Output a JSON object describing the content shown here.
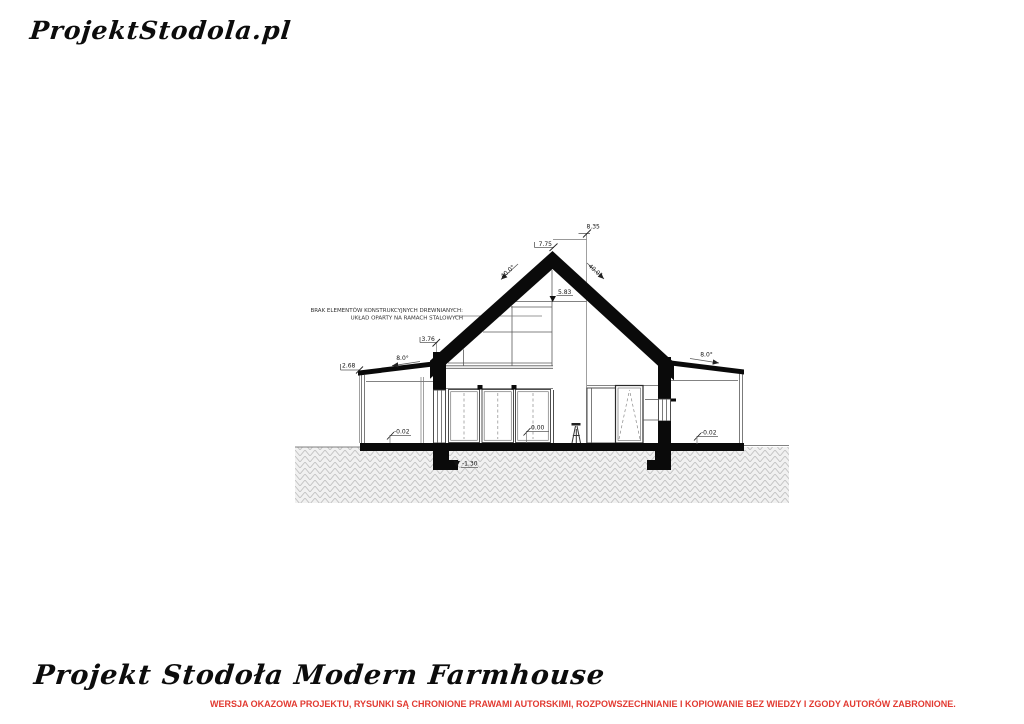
{
  "logo": "ProjektStodola.pl",
  "footer": {
    "title": "Projekt Stodoła Modern Farmhouse",
    "disclaimer": "WERSJA OKAZOWA PROJEKTU, RYSUNKI SĄ CHRONIONE PRAWAMI AUTORSKIMI, ROZPOWSZECHNIANIE I KOPIOWANIE BEZ WIEDZY I ZGODY AUTORÓW ZABRONIONE.",
    "disclaimer_color": "#e23a31"
  },
  "drawing": {
    "annotation_line1": "BRAK ELEMENTÓW KONSTRUKCYJNYCH DREWNIANYCH:",
    "annotation_line2": "UKŁAD OPARTY NA RAMACH STALOWYCH",
    "dims": {
      "ridge_top": "8.35",
      "ridge_ceiling": "7.75",
      "attic_level": "5.83",
      "eave_height": "3.76",
      "annex_edge_height": "2.68",
      "floor_level": "0.00",
      "terrace_level_left": "-0.02",
      "terrace_level_right": "-0.02",
      "foundation_depth": "-1.30",
      "roof_angle_left": "40.0°",
      "roof_angle_right": "40.0°",
      "annex_roof_angle_left": "8.0°",
      "annex_roof_angle_right": "8.0°"
    }
  }
}
